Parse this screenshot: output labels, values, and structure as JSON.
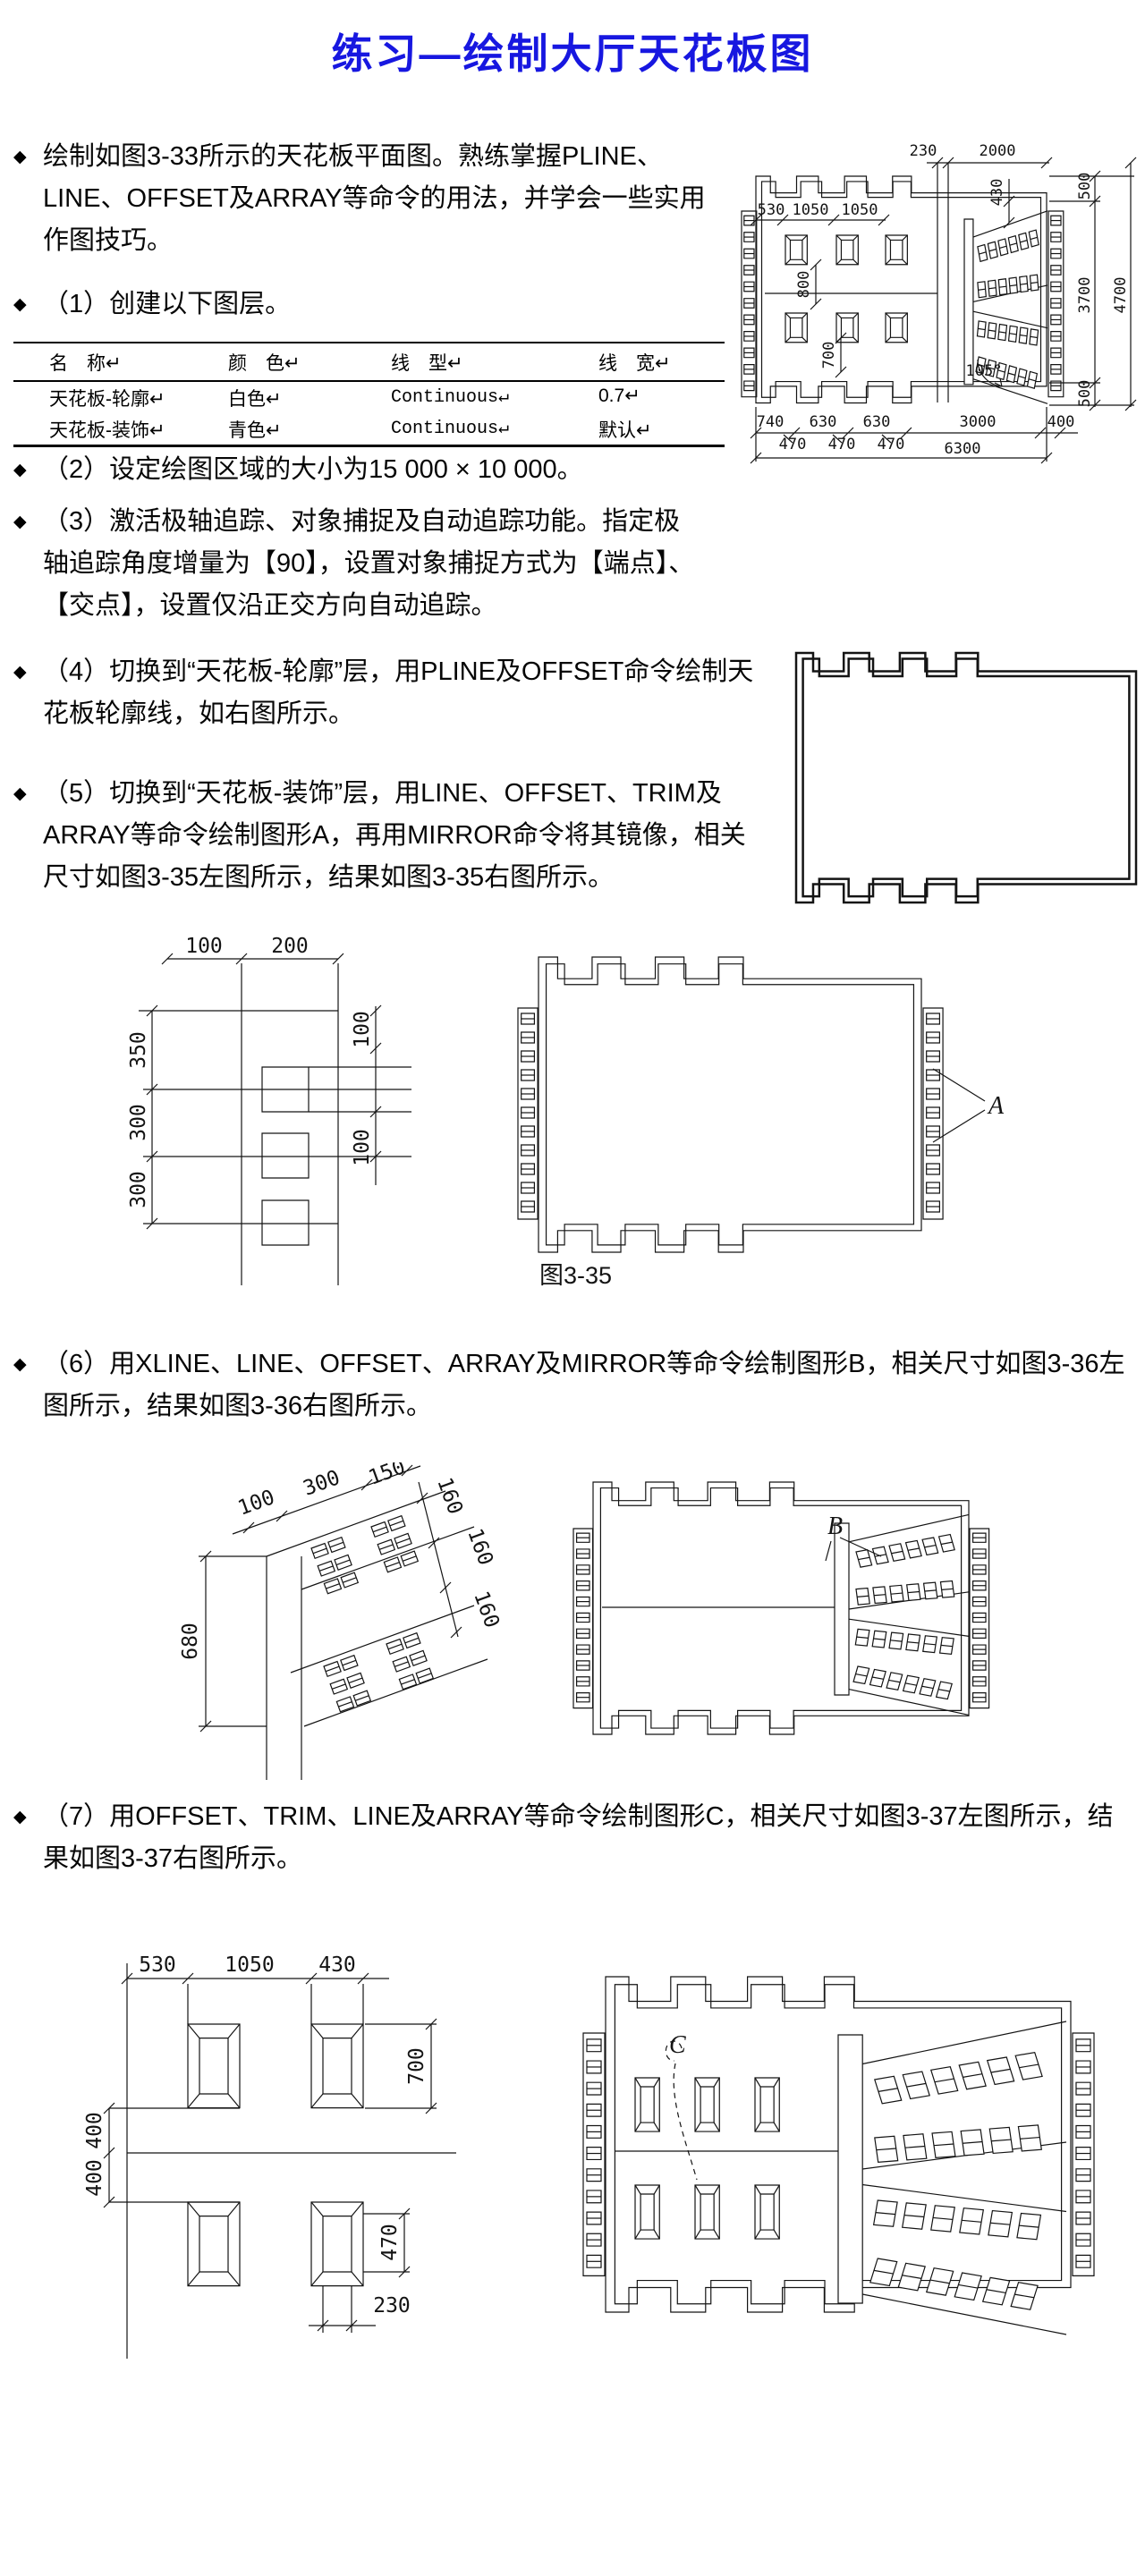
{
  "title": "练习—绘制大厅天花板图",
  "colors": {
    "title_blue": "#1717e0",
    "drawing_line": "#141414",
    "background": "#ffffff"
  },
  "bullets": [
    "绘制如图3-33所示的天花板平面图。熟练掌握PLINE、LINE、OFFSET及ARRAY等命令的用法，并学会一些实用作图技巧。",
    "（1）创建以下图层。",
    "（2）设定绘图区域的大小为15 000 × 10 000。",
    "（3）激活极轴追踪、对象捕捉及自动追踪功能。指定极轴追踪角度增量为【90】，设置对象捕捉方式为【端点】、【交点】，设置仅沿正交方向自动追踪。",
    "（4）切换到“天花板-轮廓”层，用PLINE及OFFSET命令绘制天花板轮廓线，如右图所示。",
    "（5）切换到“天花板-装饰”层，用LINE、OFFSET、TRIM及ARRAY等命令绘制图形A，再用MIRROR命令将其镜像，相关尺寸如图3-35左图所示，结果如图3-35右图所示。",
    "（6）用XLINE、LINE、OFFSET、ARRAY及MIRROR等命令绘制图形B，相关尺寸如图3-36左图所示，结果如图3-36右图所示。",
    "（7）用OFFSET、TRIM、LINE及ARRAY等命令绘制图形C，相关尺寸如图3-37左图所示，结果如图3-37右图所示。"
  ],
  "bullet_marker": "◆",
  "layer_table": {
    "headers": [
      "名　称↵",
      "颜　色↵",
      "线　型↵",
      "线　宽↵"
    ],
    "rows": [
      [
        "天花板-轮廓↵",
        "白色↵",
        "Continuous↵",
        "0.7↵"
      ],
      [
        "天花板-装饰↵",
        "青色↵",
        "Continuous↵",
        "默认↵"
      ]
    ]
  },
  "figures": {
    "fig33": {
      "top_dims": [
        "230",
        "2000"
      ],
      "inner_top_dims": [
        "530",
        "1050",
        "1050"
      ],
      "v_dims": [
        "430",
        "800",
        "700"
      ],
      "right_dims": [
        "500",
        "3700",
        "4700",
        "500"
      ],
      "bottom_row1": [
        "740",
        "630",
        "630",
        "3000",
        "400"
      ],
      "bottom_row2": [
        "470",
        "470",
        "470"
      ],
      "bottom_total": "6300",
      "angle": "105°"
    },
    "fig35_left": {
      "top_dims": [
        "100",
        "200"
      ],
      "left_dims": [
        "350",
        "300",
        "300"
      ],
      "right_dims": [
        "100",
        "100"
      ]
    },
    "fig35_right": {
      "label": "A",
      "caption": "图3-35"
    },
    "fig36_left": {
      "top_dims": [
        "100",
        "300",
        "150"
      ],
      "right_dims": [
        "160",
        "160",
        "160"
      ],
      "height_dim": "680"
    },
    "fig36_right": {
      "label": "B"
    },
    "fig37_left": {
      "top_dims": [
        "530",
        "1050",
        "430"
      ],
      "right_dim": "700",
      "left_dims": [
        "400",
        "400"
      ],
      "height_dim": "470",
      "bottom_dim": "230"
    },
    "fig37_right": {
      "label": "C"
    }
  }
}
